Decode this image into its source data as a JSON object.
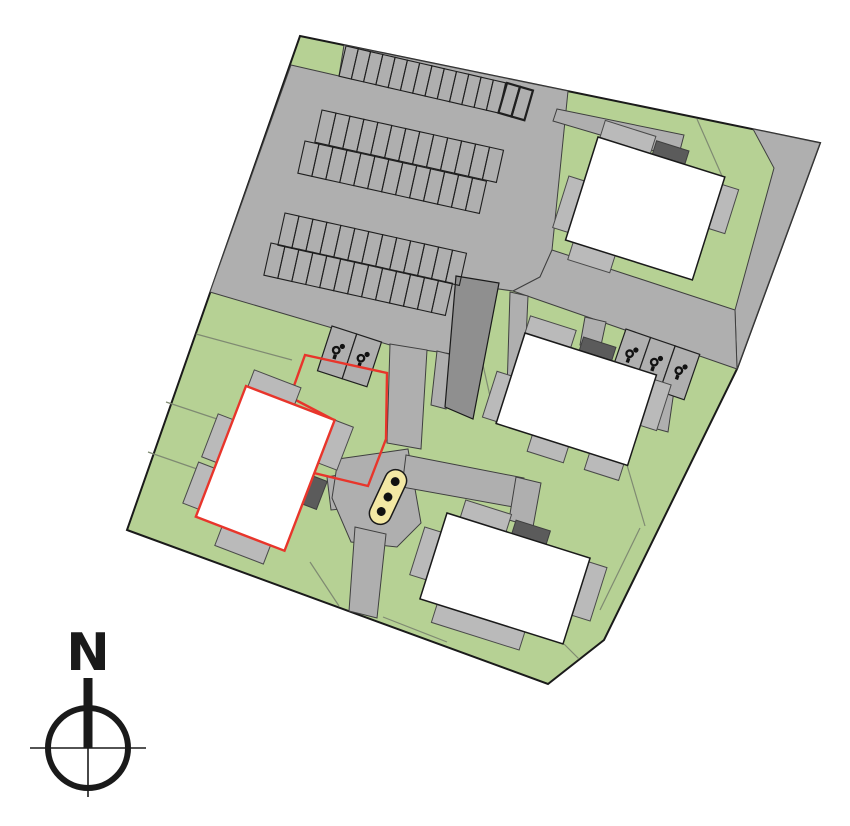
{
  "site_plan": {
    "canvas": {
      "width": 850,
      "height": 826
    },
    "colors": {
      "background": "#ffffff",
      "green": "#b6d194",
      "road": "#afafaf",
      "road_edge": "#3f3f3f",
      "stall_line": "#1f1f1f",
      "patio": "#bababa",
      "patio_edge": "#4a4a4a",
      "entrance": "#5b5b5b",
      "structure": "#8f8f8f",
      "building": "#ffffff",
      "outline": "#1a1a1a",
      "division": "#7f8a72",
      "red": "#e8352b",
      "yellow": "#f3e8a4",
      "icon_black": "#111111",
      "compass_black": "#1a1a1a"
    },
    "site_outline": [
      [
        300,
        36
      ],
      [
        820,
        143
      ],
      [
        737,
        369
      ],
      [
        604,
        640
      ],
      [
        548,
        684
      ],
      [
        127,
        530
      ]
    ],
    "pavements": [
      {
        "name": "parking-lot",
        "points": [
          [
            291,
            65
          ],
          [
            339,
            76
          ],
          [
            344,
            45
          ],
          [
            568,
            91
          ],
          [
            552,
            250
          ],
          [
            540,
            277
          ],
          [
            513,
            291
          ],
          [
            456,
            283
          ],
          [
            452,
            354
          ],
          [
            390,
            345
          ],
          [
            210,
            292
          ]
        ]
      },
      {
        "name": "right-road-strip",
        "points": [
          [
            753,
            129
          ],
          [
            820,
            143
          ],
          [
            737,
            369
          ],
          [
            735,
            310
          ],
          [
            774,
            168
          ]
        ]
      },
      {
        "name": "east-road-band",
        "points": [
          [
            552,
            250
          ],
          [
            735,
            310
          ],
          [
            737,
            369
          ],
          [
            513,
            291
          ],
          [
            540,
            277
          ]
        ]
      },
      {
        "name": "central-path",
        "points": [
          [
            390,
            344
          ],
          [
            427,
            350
          ],
          [
            421,
            449
          ],
          [
            387,
            443
          ]
        ]
      },
      {
        "name": "west-walk",
        "points": [
          [
            437,
            351
          ],
          [
            453,
            355
          ],
          [
            446,
            409
          ],
          [
            431,
            405
          ]
        ]
      },
      {
        "name": "east-walk",
        "points": [
          [
            510,
            292
          ],
          [
            528,
            296
          ],
          [
            522,
            428
          ],
          [
            506,
            423
          ]
        ]
      },
      {
        "name": "entrance-path-west",
        "points": [
          [
            327,
            477
          ],
          [
            390,
            466
          ],
          [
            394,
            504
          ],
          [
            331,
            510
          ]
        ]
      },
      {
        "name": "waste-pad-surround",
        "points": [
          [
            338,
            459
          ],
          [
            408,
            449
          ],
          [
            421,
            523
          ],
          [
            397,
            547
          ],
          [
            351,
            542
          ],
          [
            332,
            498
          ]
        ]
      },
      {
        "name": "south-path",
        "points": [
          [
            355,
            527
          ],
          [
            386,
            534
          ],
          [
            377,
            618
          ],
          [
            349,
            611
          ]
        ]
      },
      {
        "name": "path-to-south-building",
        "points": [
          [
            406,
            455
          ],
          [
            524,
            478
          ],
          [
            519,
            508
          ],
          [
            402,
            487
          ]
        ]
      },
      {
        "name": "south-building-stub",
        "points": [
          [
            516,
            477
          ],
          [
            541,
            483
          ],
          [
            533,
            527
          ],
          [
            509,
            520
          ]
        ]
      },
      {
        "name": "middle-building-stub",
        "points": [
          [
            585,
            317
          ],
          [
            606,
            322
          ],
          [
            600,
            350
          ],
          [
            580,
            345
          ]
        ]
      },
      {
        "name": "north-building-walkway",
        "points": [
          [
            557,
            109
          ],
          [
            684,
            135
          ],
          [
            678,
            158
          ],
          [
            553,
            121
          ]
        ]
      },
      {
        "name": "stalls-stub",
        "points": [
          [
            652,
            378
          ],
          [
            675,
            384
          ],
          [
            668,
            432
          ],
          [
            646,
            426
          ]
        ]
      }
    ],
    "divisions": [
      [
        196,
        334,
        292,
        360
      ],
      [
        166,
        402,
        229,
        423
      ],
      [
        148,
        452,
        197,
        469
      ],
      [
        310,
        562,
        339,
        606
      ],
      [
        454,
        536,
        464,
        625
      ],
      [
        383,
        617,
        447,
        642
      ],
      [
        627,
        465,
        645,
        526
      ],
      [
        697,
        119,
        722,
        176
      ],
      [
        481,
        356,
        496,
        423
      ],
      [
        564,
        644,
        579,
        659
      ],
      [
        600,
        610,
        640,
        528
      ]
    ],
    "dark_structure": [
      [
        456,
        276
      ],
      [
        499,
        283
      ],
      [
        473,
        419
      ],
      [
        445,
        407
      ]
    ],
    "parking_rows": [
      {
        "x": 346,
        "y": 46,
        "angle": 13,
        "count": 13,
        "pitch": 12.6,
        "depth": 31,
        "bold": false
      },
      {
        "x": 507,
        "y": 83,
        "angle": 16,
        "count": 2,
        "pitch": 13.5,
        "depth": 31,
        "bold": true
      },
      {
        "x": 322,
        "y": 110,
        "angle": 12.5,
        "count": 13,
        "pitch": 14.3,
        "depth": 33,
        "bold": false
      },
      {
        "x": 305,
        "y": 141,
        "angle": 12.5,
        "count": 13,
        "pitch": 14.3,
        "depth": 33,
        "bold": false
      },
      {
        "x": 285,
        "y": 213,
        "angle": 12.5,
        "count": 13,
        "pitch": 14.3,
        "depth": 33,
        "bold": false
      },
      {
        "x": 271,
        "y": 243,
        "angle": 12.5,
        "count": 13,
        "pitch": 14.3,
        "depth": 33,
        "bold": false
      }
    ],
    "accessible_groups": [
      {
        "x": 332,
        "y": 326,
        "angle": 18,
        "count": 2,
        "stall_w": 26,
        "stall_h": 47
      },
      {
        "x": 626,
        "y": 329,
        "angle": 19,
        "count": 3,
        "stall_w": 26,
        "stall_h": 48
      }
    ],
    "buildings": [
      {
        "name": "building-north",
        "x": 598,
        "y": 137,
        "angle": 17.5,
        "w": 133,
        "h": 108,
        "stroke": "outline",
        "patios": [
          [
            2,
            -18,
            53,
            18
          ],
          [
            133,
            8,
            17,
            46
          ],
          [
            -16,
            46,
            16,
            54
          ],
          [
            8,
            108,
            44,
            18
          ]
        ],
        "entrances": [
          [
            57,
            -14,
            34,
            14
          ]
        ]
      },
      {
        "name": "building-middle",
        "x": 525,
        "y": 333,
        "angle": 17.7,
        "w": 138,
        "h": 95,
        "stroke": "outline",
        "patios": [
          [
            0,
            -18,
            48,
            18
          ],
          [
            138,
            5,
            17,
            48
          ],
          [
            -15,
            45,
            15,
            48
          ],
          [
            38,
            95,
            38,
            17
          ],
          [
            98,
            95,
            36,
            17
          ]
        ],
        "entrances": [
          [
            57,
            -14,
            34,
            14
          ]
        ]
      },
      {
        "name": "building-west-highlighted",
        "x": 246,
        "y": 386,
        "angle": 21,
        "w": 95,
        "h": 140,
        "stroke": "red",
        "patios": [
          [
            2,
            -18,
            50,
            18
          ],
          [
            95,
            0,
            20,
            46
          ],
          [
            -16,
            36,
            16,
            46
          ],
          [
            -17,
            88,
            17,
            44
          ],
          [
            28,
            140,
            52,
            20
          ]
        ],
        "entrances": [
          [
            95,
            60,
            15,
            30
          ]
        ]
      },
      {
        "name": "building-south",
        "x": 447,
        "y": 513,
        "angle": 17.5,
        "w": 150,
        "h": 90,
        "stroke": "outline",
        "patios": [
          [
            14,
            -18,
            48,
            18
          ],
          [
            -17,
            20,
            17,
            50
          ],
          [
            150,
            4,
            19,
            56
          ],
          [
            18,
            90,
            92,
            19
          ]
        ],
        "entrances": [
          [
            68,
            -14,
            36,
            14
          ]
        ]
      }
    ],
    "red_parcel": [
      [
        290,
        397
      ],
      [
        305,
        355
      ],
      [
        387,
        373
      ],
      [
        386,
        439
      ],
      [
        368,
        486
      ],
      [
        314,
        473
      ],
      [
        334,
        420
      ]
    ],
    "waste_pad": {
      "cx": 388,
      "cy": 497,
      "w": 22,
      "h": 58,
      "rx": 11,
      "angle": 25,
      "dot_offsets": [
        -17,
        0,
        16
      ],
      "dot_r": 4.2
    },
    "compass": {
      "label": "N",
      "cx": 88,
      "cy": 748,
      "r": 40,
      "label_x": 88,
      "label_y": 670,
      "font_size": 52,
      "bar_top": 678,
      "h_half": 58,
      "v_below": 49
    }
  }
}
